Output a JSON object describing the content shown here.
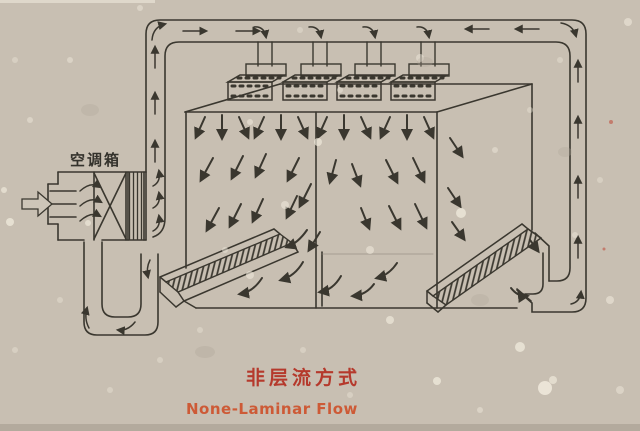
{
  "figure": {
    "background_color": "#c8bfb2",
    "line_color": "#3a372f"
  },
  "ac_unit": {
    "label": "空调箱"
  },
  "caption": {
    "title_zh": "非层流方式",
    "title_zh_color": "#b5392c",
    "title_en": "None-Laminar Flow",
    "title_en_color": "#cd5a36"
  }
}
